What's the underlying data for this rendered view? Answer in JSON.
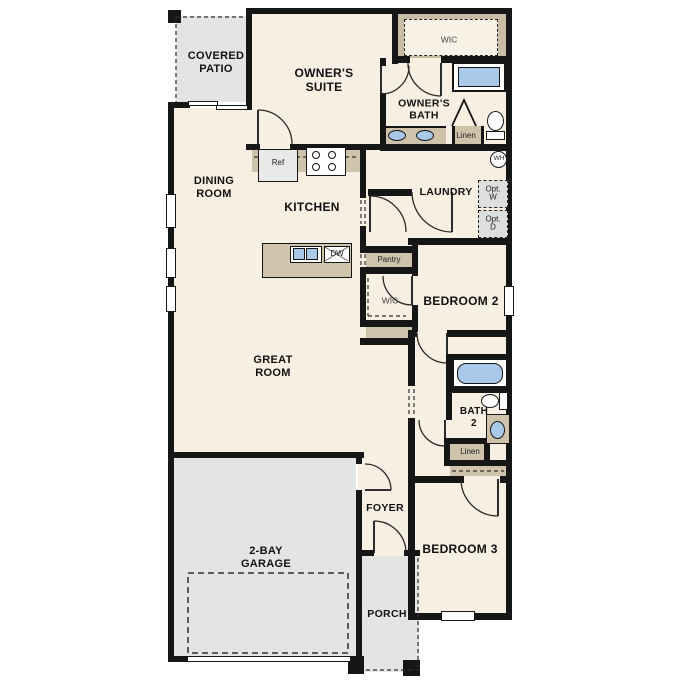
{
  "colors": {
    "floor": "#f6efe2",
    "outdoor": "#e4e4e2",
    "counter": "#cfc3ab",
    "closet": "#c9bca4",
    "fixture_blue": "#a9c9e9",
    "wall": "#161616",
    "optbox": "#dededc",
    "wic_inner": "#f8f2e6"
  },
  "labels": {
    "covered_patio": "COVERED\nPATIO",
    "owners_suite": "OWNER'S\nSUITE",
    "wic": "WIC",
    "owners_bath": "OWNER'S\nBATH",
    "linen": "Linen",
    "wh": "WH",
    "dining_room": "DINING\nROOM",
    "kitchen": "KITCHEN",
    "laundry": "LAUNDRY",
    "opt_w": "Opt.\nW",
    "opt_d": "Opt.\nD",
    "ref": "Ref",
    "dw": "DW",
    "pantry": "Pantry",
    "wic2": "WIC",
    "bedroom2": "BEDROOM 2",
    "great_room": "GREAT\nROOM",
    "bath2": "BATH\n2",
    "linen2": "Linen",
    "bedroom3": "BEDROOM 3",
    "garage": "2-BAY\nGARAGE",
    "foyer": "FOYER",
    "porch": "PORCH"
  }
}
